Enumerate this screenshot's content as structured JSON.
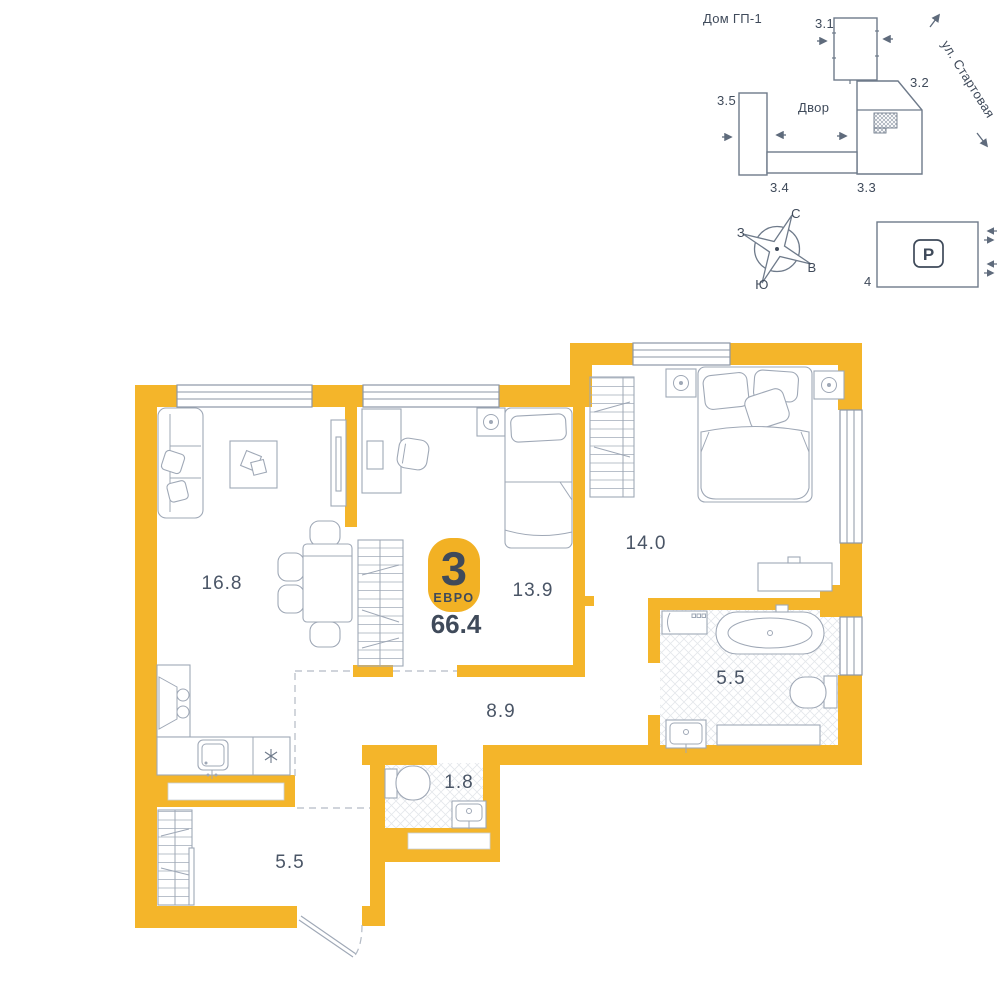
{
  "colors": {
    "accent_wall": "#F4B52A",
    "badge": "#F2B124",
    "text_dark": "#3F4A5A",
    "room_label": "#4A5566",
    "furniture_line": "#9FA8B6",
    "site_line": "#6E7A8A"
  },
  "site_plan": {
    "title": "Дом ГП-1",
    "yard_label": "Двор",
    "street_label": "ул. Стартовая",
    "building_31": "3.1",
    "building_32": "3.2",
    "building_33": "3.3",
    "building_34": "3.4",
    "building_35": "3.5"
  },
  "compass": {
    "north": "С",
    "east": "В",
    "south": "Ю",
    "west": "З"
  },
  "parking": {
    "sign": "P",
    "label": "4"
  },
  "apartment": {
    "badge_count": "3",
    "badge_type": "ЕВРО",
    "total_area": "66.4",
    "rooms": [
      {
        "name": "living-kitchen",
        "area": "16.8"
      },
      {
        "name": "bedroom-small",
        "area": "13.9"
      },
      {
        "name": "bedroom",
        "area": "14.0"
      },
      {
        "name": "bathroom",
        "area": "5.5"
      },
      {
        "name": "hall",
        "area": "8.9"
      },
      {
        "name": "wc",
        "area": "1.8"
      },
      {
        "name": "entry-hall",
        "area": "5.5"
      }
    ]
  }
}
